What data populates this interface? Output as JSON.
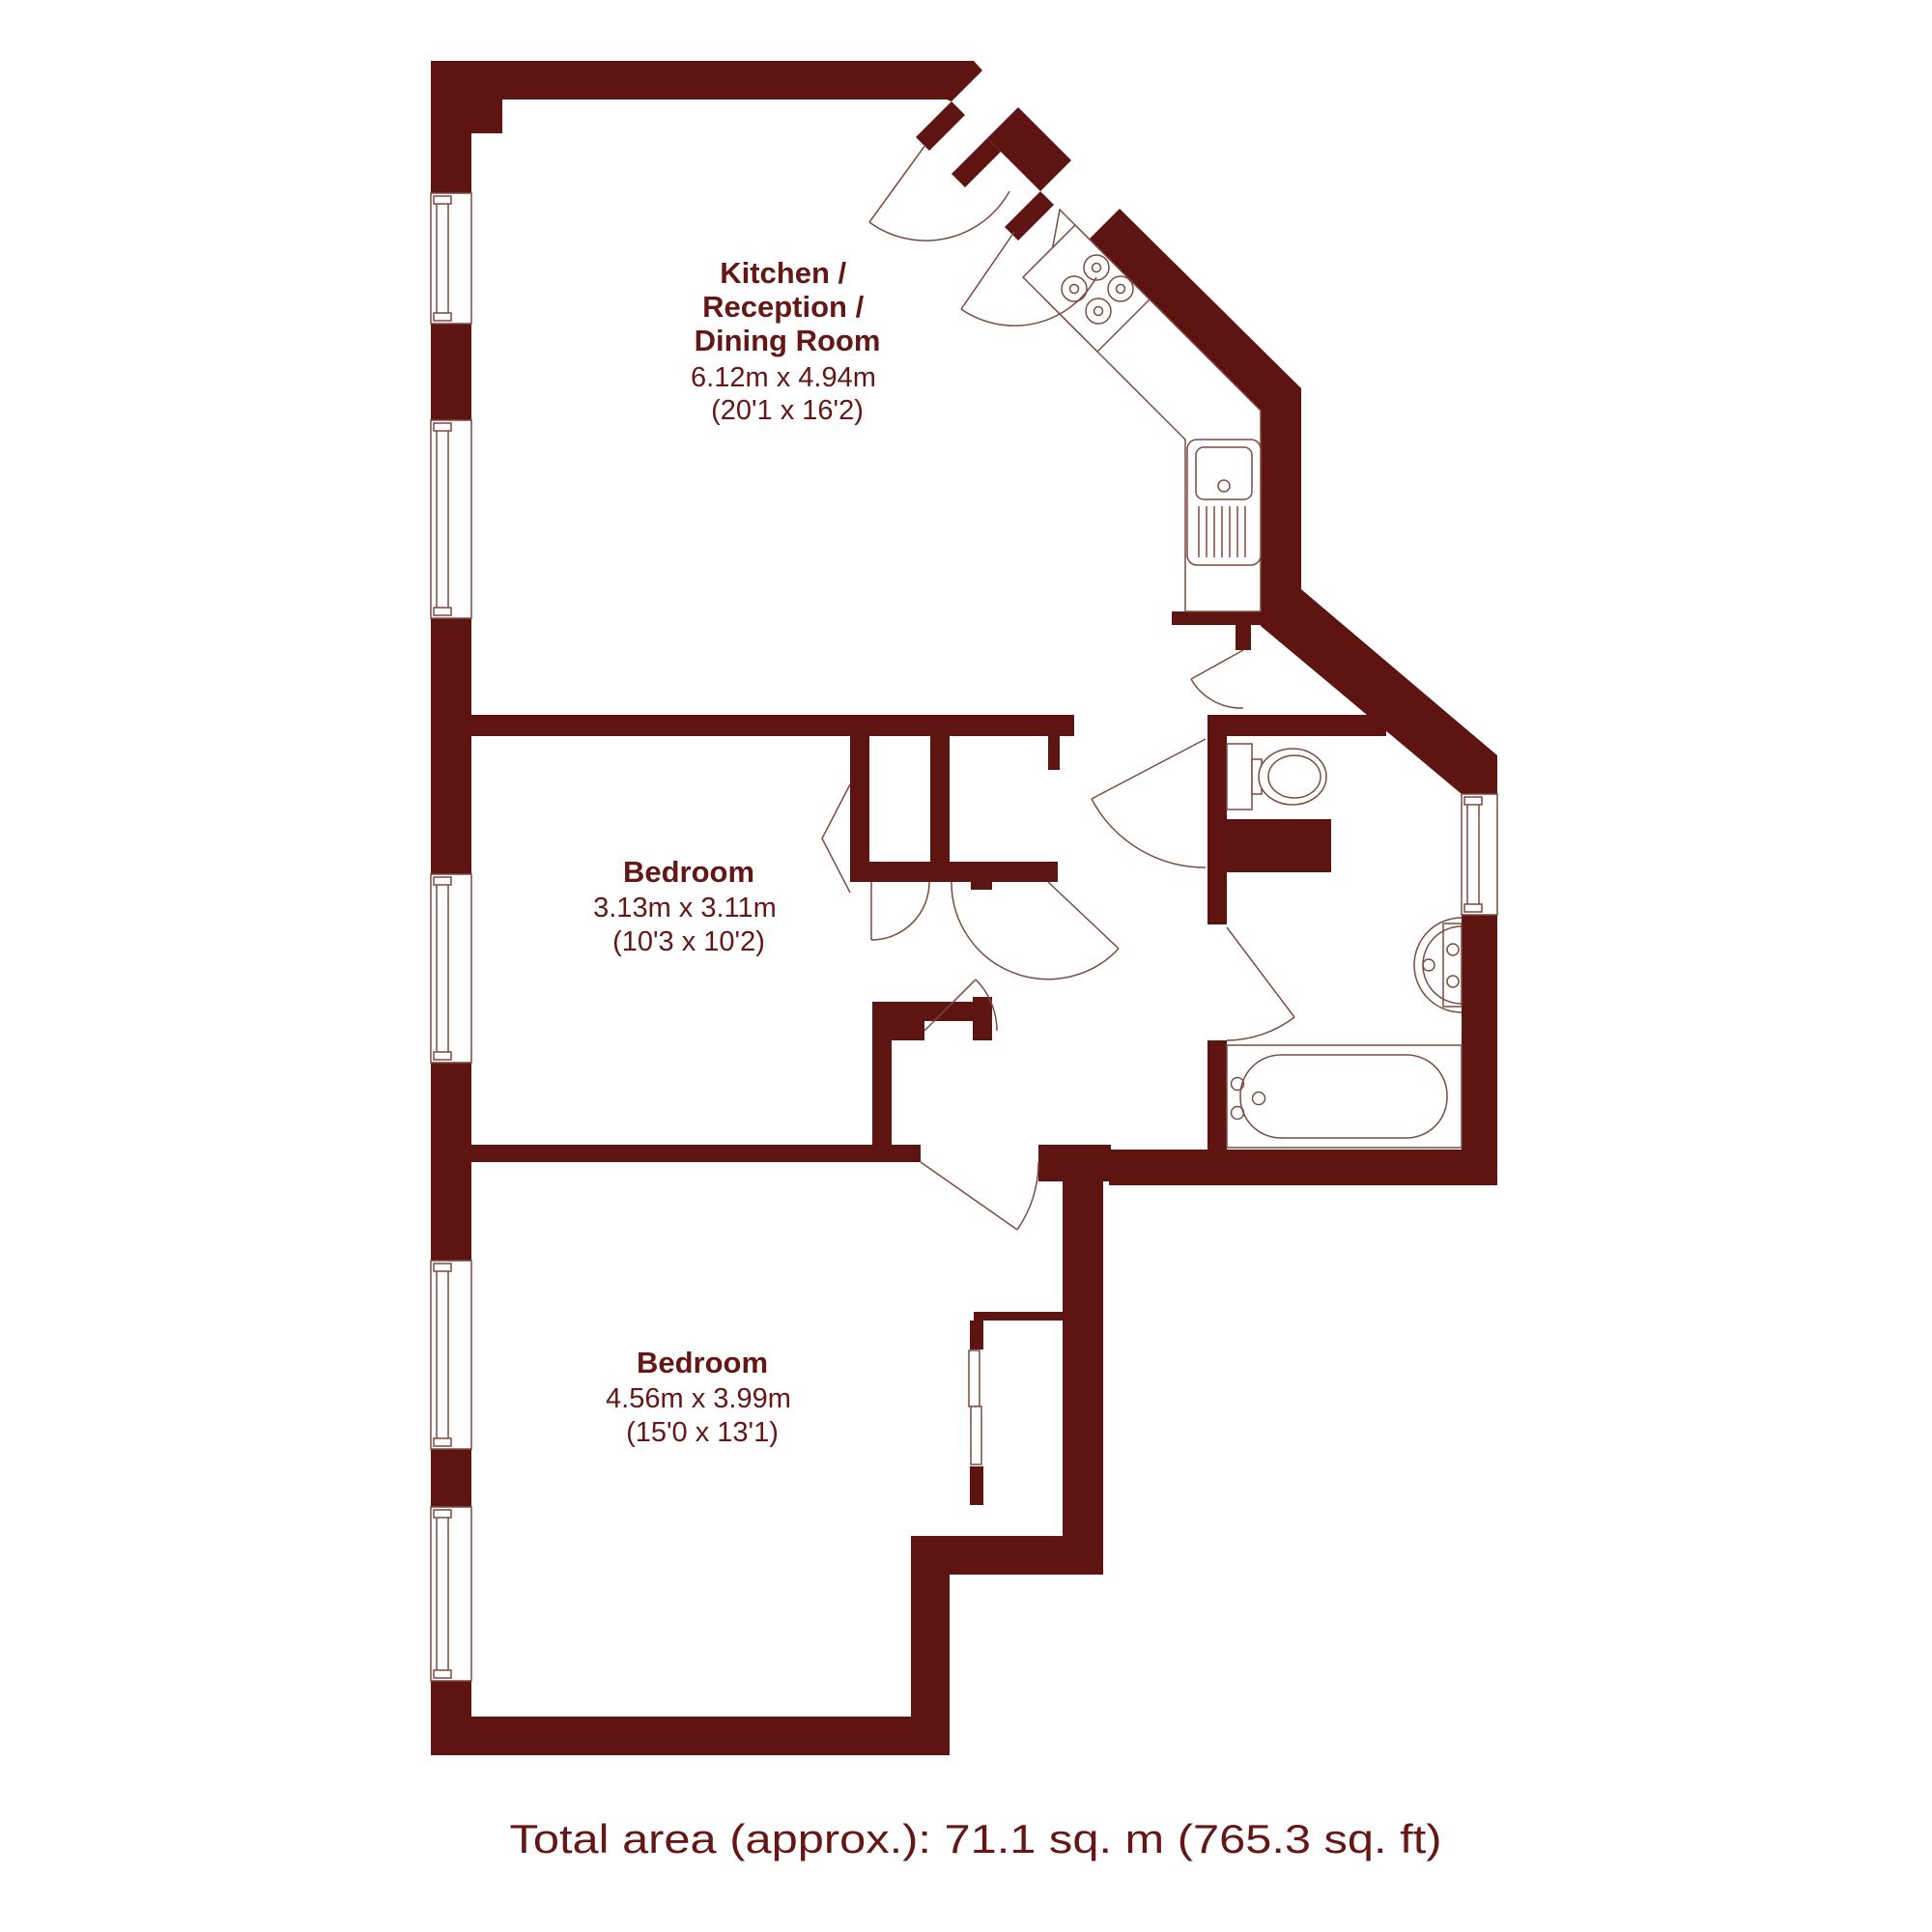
{
  "title": "Two bedroom apartment floor plan",
  "colors": {
    "wall": "#5E1411",
    "fixture_line": "#7C4A44",
    "text": "#651715",
    "background": "#ffffff"
  },
  "rooms": [
    {
      "id": "kitchen-reception-dining",
      "name_lines": [
        "Kitchen /",
        "Reception /",
        "Dining Room"
      ],
      "dims_m": "6.12m x 4.94m",
      "dims_ft": "(20'1 x 16'2)"
    },
    {
      "id": "bedroom-1",
      "name_lines": [
        "Bedroom"
      ],
      "dims_m": "3.13m x 3.11m",
      "dims_ft": "(10'3 x 10'2)"
    },
    {
      "id": "bedroom-2",
      "name_lines": [
        "Bedroom"
      ],
      "dims_m": "4.56m x 3.99m",
      "dims_ft": "(15'0 x 13'1)"
    }
  ],
  "fixtures": [
    "hob",
    "kitchen-counter",
    "sink-drainer",
    "toilet",
    "basin",
    "bathtub",
    "sliding-wardrobe"
  ],
  "openings": [
    "entrance-door",
    "hall-door",
    "kitchen-door",
    "bedroom-1-door",
    "bedroom-2-door",
    "bathroom-door",
    "closet-doors",
    "bifold-door"
  ],
  "windows_count": 6,
  "footer": {
    "total_area": "Total area (approx.): 71.1 sq. m (765.3 sq. ft)"
  }
}
